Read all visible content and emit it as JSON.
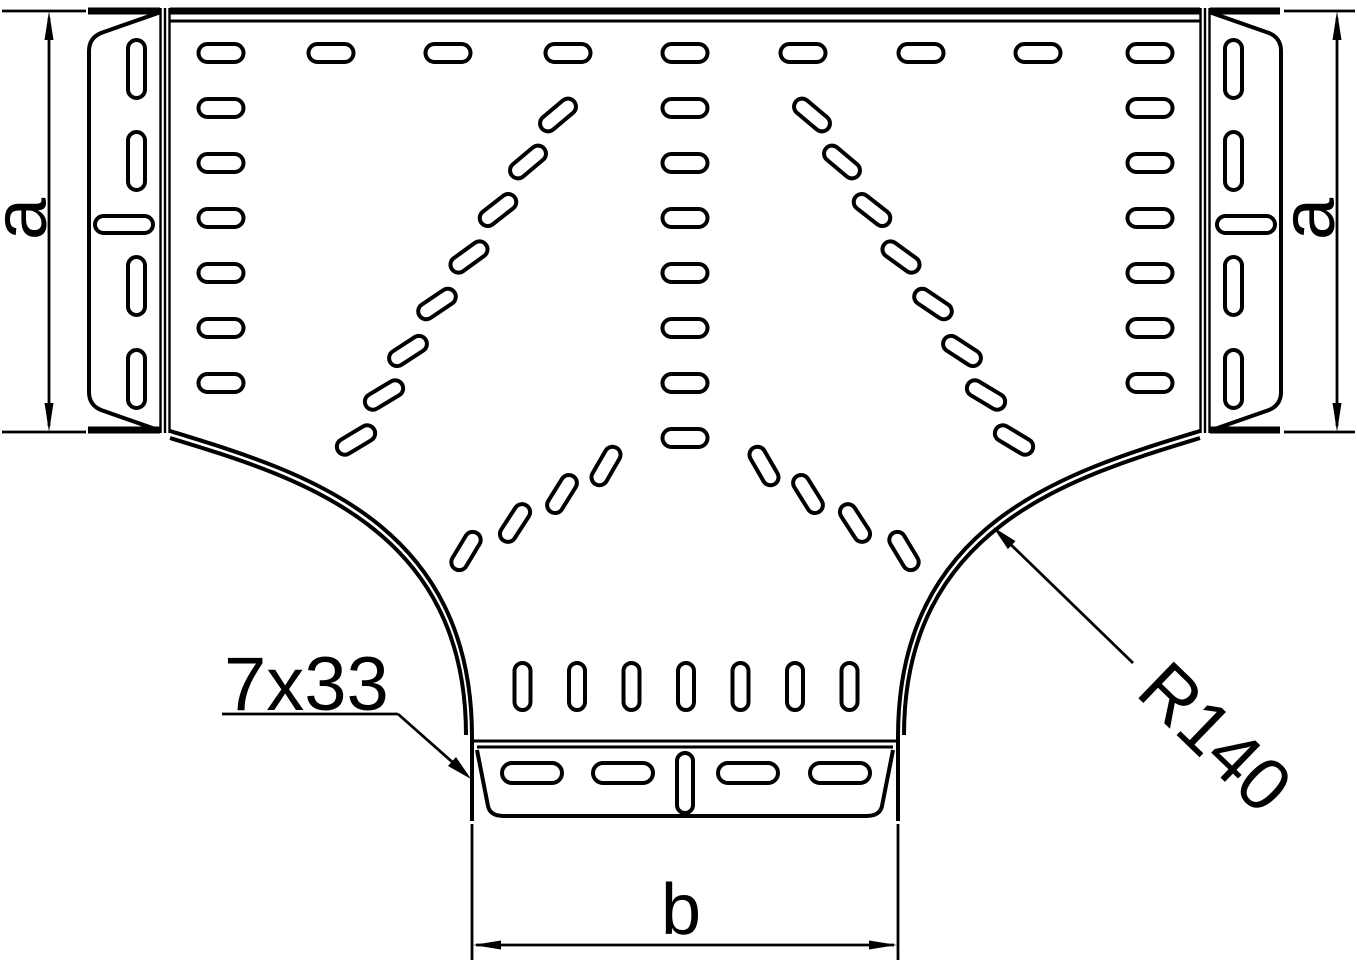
{
  "labels": {
    "width_left": "a",
    "width_right": "a",
    "branch_width": "b",
    "perforation_callout": "7x33",
    "radius_callout": "R140"
  },
  "colors": {
    "stroke": "#000000",
    "background": "#ffffff"
  }
}
